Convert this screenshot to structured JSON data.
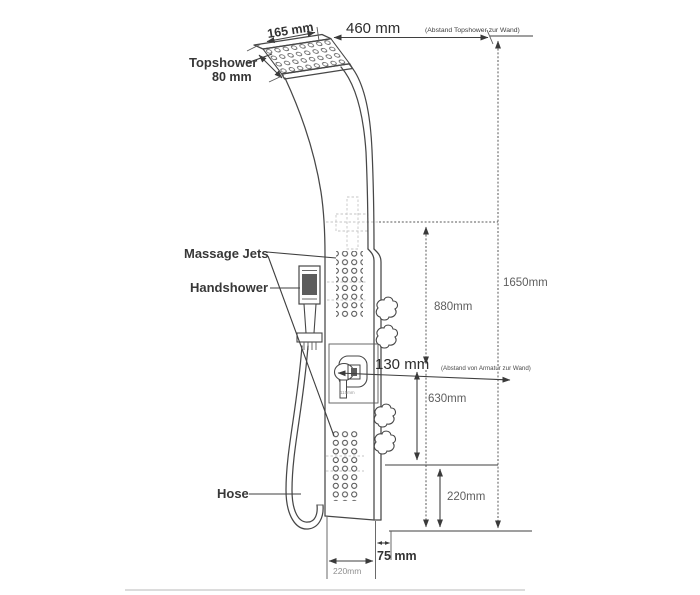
{
  "labels": {
    "topshower": "Topshower",
    "massage_jets": "Massage Jets",
    "handshower": "Handshower",
    "hose": "Hose"
  },
  "dims": {
    "d165": "165 mm",
    "d460": "460 mm",
    "d460_note": "(Abstand Topshower zur Wand)",
    "d80": "80 mm",
    "d1650": "1650mm",
    "d880": "880mm",
    "d130": "130 mm",
    "d130_note": "(Abstand von Armatur zur Wand)",
    "d115": "115mm",
    "d630": "630mm",
    "d220_right": "220mm",
    "d75": "75 mm",
    "d220_bottom": "220mm"
  },
  "colors": {
    "line": "#474747",
    "dim_text": "#5e5e5e",
    "background": "#ffffff"
  }
}
